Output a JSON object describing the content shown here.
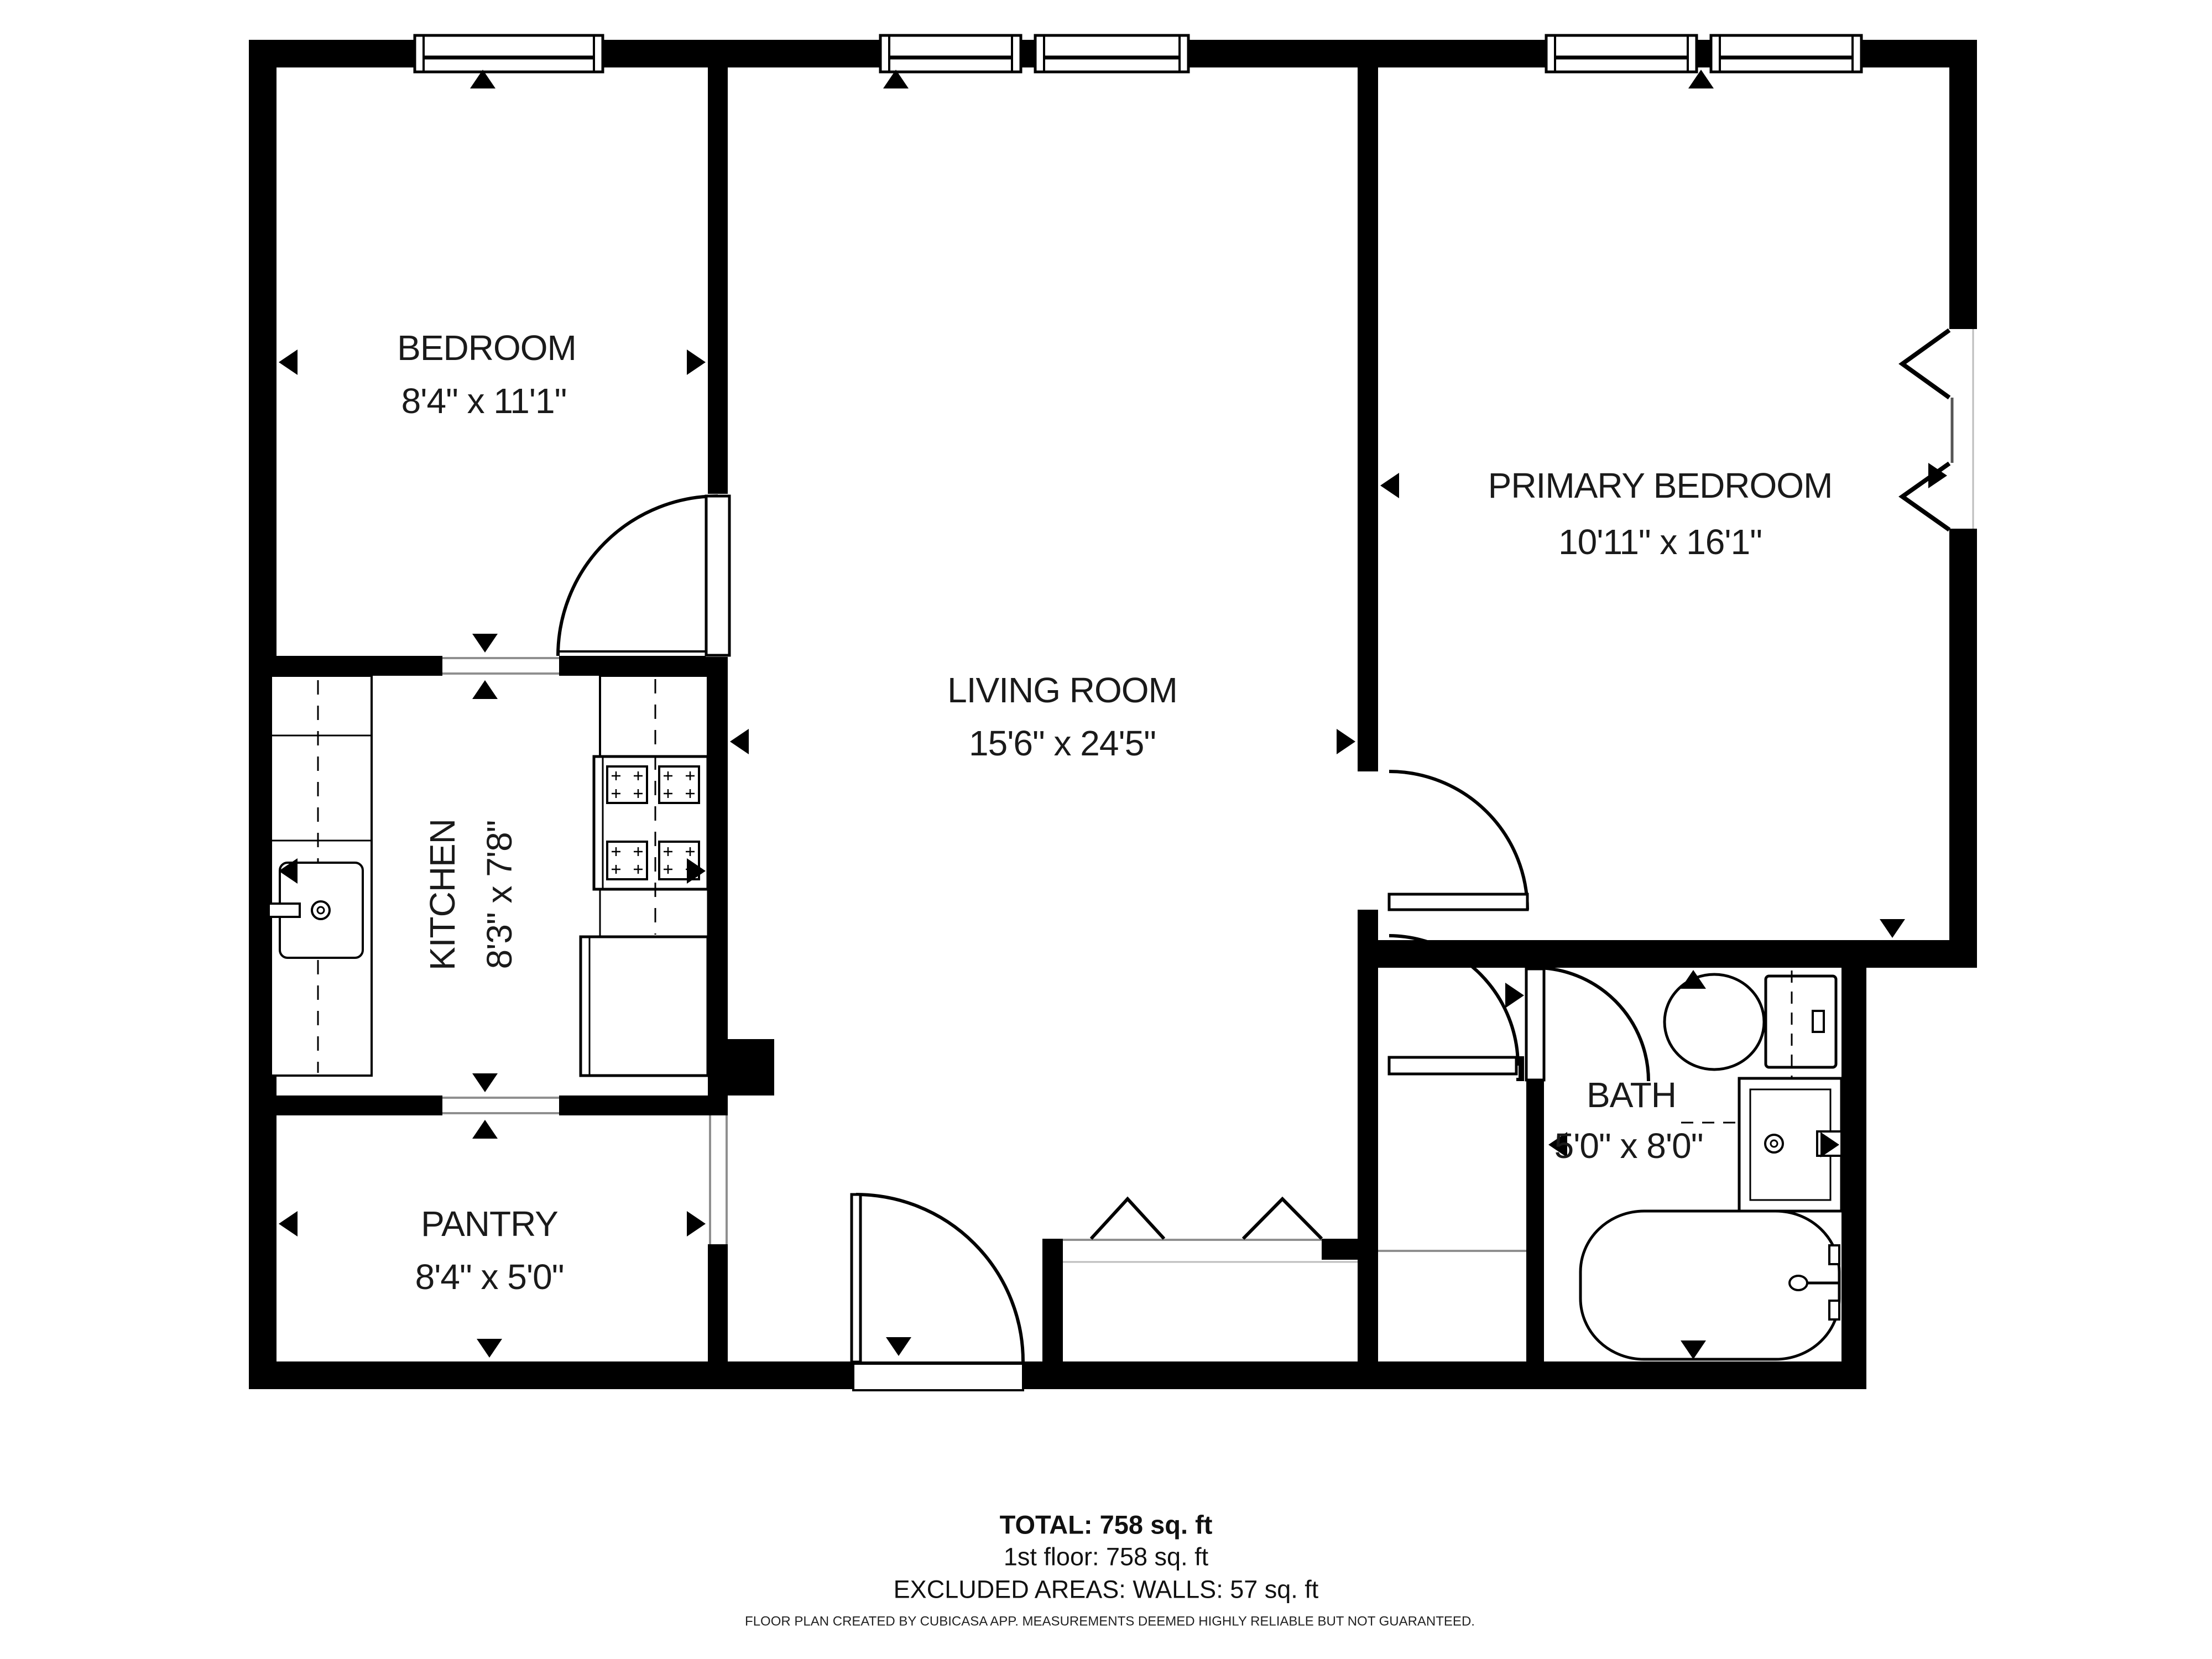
{
  "rooms": [
    {
      "name": "BEDROOM",
      "dims": "8'4\" x 11'1\""
    },
    {
      "name": "LIVING ROOM",
      "dims": "15'6\" x 24'5\""
    },
    {
      "name": "PRIMARY BEDROOM",
      "dims": "10'11\" x 16'1\""
    },
    {
      "name": "KITCHEN",
      "dims": "8'3\" x 7'8\""
    },
    {
      "name": "PANTRY",
      "dims": "8'4\" x 5'0\""
    },
    {
      "name": "BATH",
      "dims": "5'0\" x 8'0\""
    }
  ],
  "summary": {
    "total": "TOTAL: 758 sq. ft",
    "floor": "1st floor: 758 sq. ft",
    "excluded": "EXCLUDED AREAS: WALLS: 57 sq. ft"
  },
  "footer": {
    "disclaimer": "FLOOR PLAN CREATED BY CUBICASA APP. MEASUREMENTS DEEMED HIGHLY RELIABLE BUT NOT GUARANTEED."
  },
  "icons": {
    "measurement-arrow": "black triangle",
    "door-swing": "quarter arc with leaf",
    "window": "framed white rect in wall",
    "bifold-door": "zigzag tent lines"
  },
  "colors": {
    "walls": "#000000",
    "background": "#ffffff",
    "thin_line": "#8f8f8f",
    "text": "#1a1a1a"
  }
}
